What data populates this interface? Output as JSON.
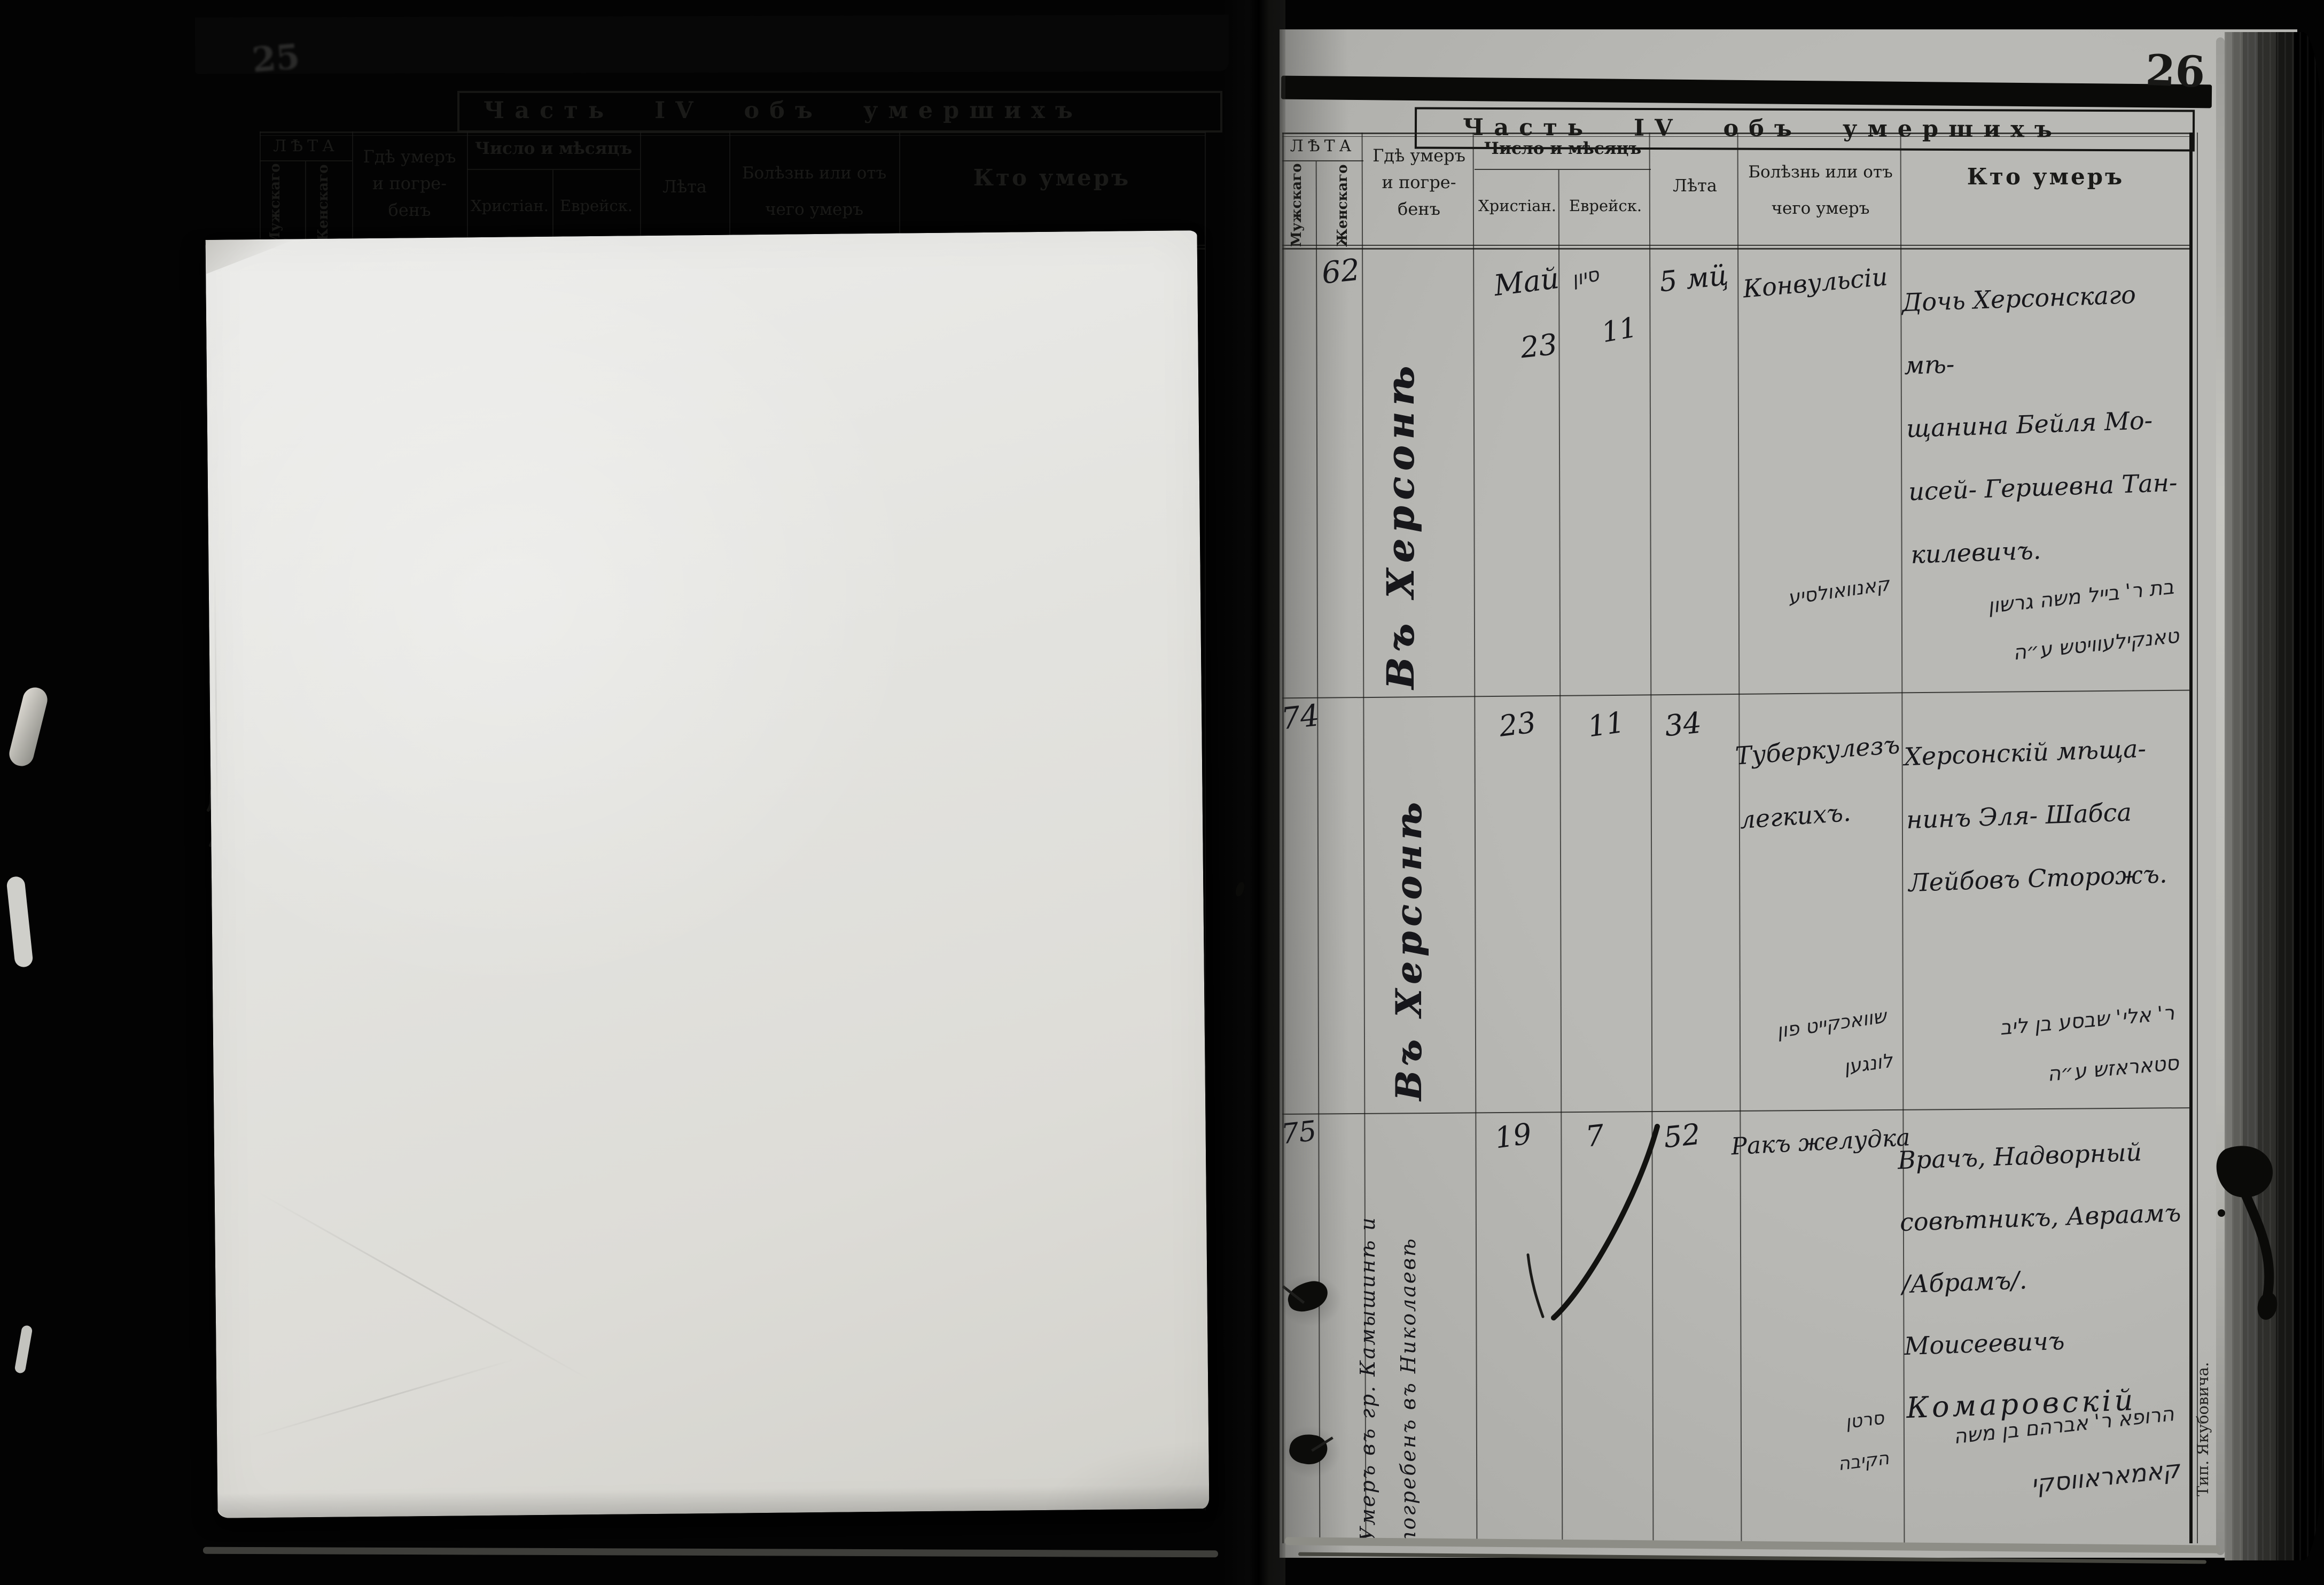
{
  "page_number": "26",
  "shared_headers": {
    "age_group": "ЛѢТА",
    "male": "Мужскаго",
    "female": "Женскаго",
    "where_lines": [
      "Гдѣ умеръ",
      "и погре-",
      "бенъ"
    ],
    "date_group": "Число и мѣсяцъ",
    "christian": "Христіан.",
    "jewish": "Еврейск.",
    "age": "Лѣта",
    "cause_lines": [
      "Болѣзнь или отъ",
      "чего умеръ"
    ],
    "who": "Кто умеръ"
  },
  "left_page": {
    "title": "Часть IV объ умершихъ",
    "faint_page_number": "25"
  },
  "right_page": {
    "title": "Часть IV объ умершихъ",
    "printer_note": "Тип. Якубовича.",
    "entries": [
      {
        "number": "62",
        "place_vertical": "Въ Херсонѣ",
        "date_christian_month": "Май",
        "date_christian_day": "23",
        "date_jewish_month": "סיון",
        "date_jewish_day": "11",
        "age": "5 мц̈",
        "cause": "Конвульсіи",
        "who_lines": [
          "Дочь Херсонскаго мѣ-",
          "щанина Бейля Мо-",
          "исей- Гершевна Тан-",
          "килевичъ."
        ],
        "cause_hebrew_lines": [
          "קאנוואולסיע"
        ],
        "who_hebrew_lines": [
          "בת ר' בייל משה גרשון",
          "טאנקילעוויטש ע״ה"
        ]
      },
      {
        "number": "74",
        "place_vertical": "Въ Херсонѣ",
        "date_christian_day": "23",
        "date_jewish_day": "11",
        "age": "34",
        "cause_lines": [
          "Туберкулезъ",
          "легкихъ."
        ],
        "who_lines": [
          "Херсонскій мѣща-",
          "нинъ Эля- Шабса",
          "Лейбовъ Сторожъ."
        ],
        "cause_hebrew_lines": [
          "שוואכקייט פון",
          "לונגען"
        ],
        "who_hebrew_lines": [
          "ר' אלי' שבסע בן ליב",
          "סטאראזש ע״ה"
        ]
      },
      {
        "number": "75",
        "place_vertical_lines": [
          "Умеръ въ гр. Камышинѣ и",
          "погребенъ въ Николаевѣ"
        ],
        "date_christian_day": "19",
        "date_jewish_day": "7",
        "age": "52",
        "cause": "Ракъ желудка",
        "who_lines": [
          "Врачъ, Надворный",
          "совѣтникъ, Авраамъ",
          "/Абрамъ/. Моисеевичъ",
          "Комаровскій"
        ],
        "cause_hebrew_lines": [
          "סרטן",
          "הקיבה"
        ],
        "who_hebrew_lines": [
          "הרופא ר' אברהם בן משה",
          "קאמאראווסקי"
        ]
      }
    ]
  }
}
